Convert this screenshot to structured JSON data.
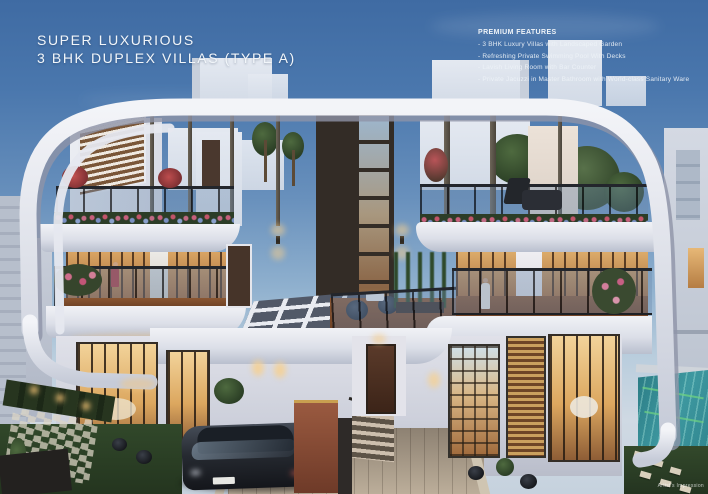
{
  "page": {
    "title_line1": "SUPER LUXURIOUS",
    "title_line2": "3 BHK DUPLEX VILLAS (TYPE A)",
    "features": {
      "heading": "PREMIUM FEATURES",
      "items": [
        "- 3 BHK Luxury Villas with Landscaped Garden",
        "- Refreshing Private Swimming Pool With Decks",
        "- Lavish Living Room with Bar Counter",
        "- Private Jacuzzi in Master Bathroom with World-class Sanitary Ware"
      ]
    },
    "credit": "Artist's Impression",
    "colors": {
      "sky_top": "#3f6ba3",
      "sky_horizon": "#cfd9e3",
      "ribbon_white": "#eef0f5",
      "warm_light": "#e9b979",
      "pool_teal": "#2f858e",
      "lawn_green": "#2e4225",
      "flower_red": "#b23a3c",
      "text_white": "#f2f6fa"
    }
  }
}
